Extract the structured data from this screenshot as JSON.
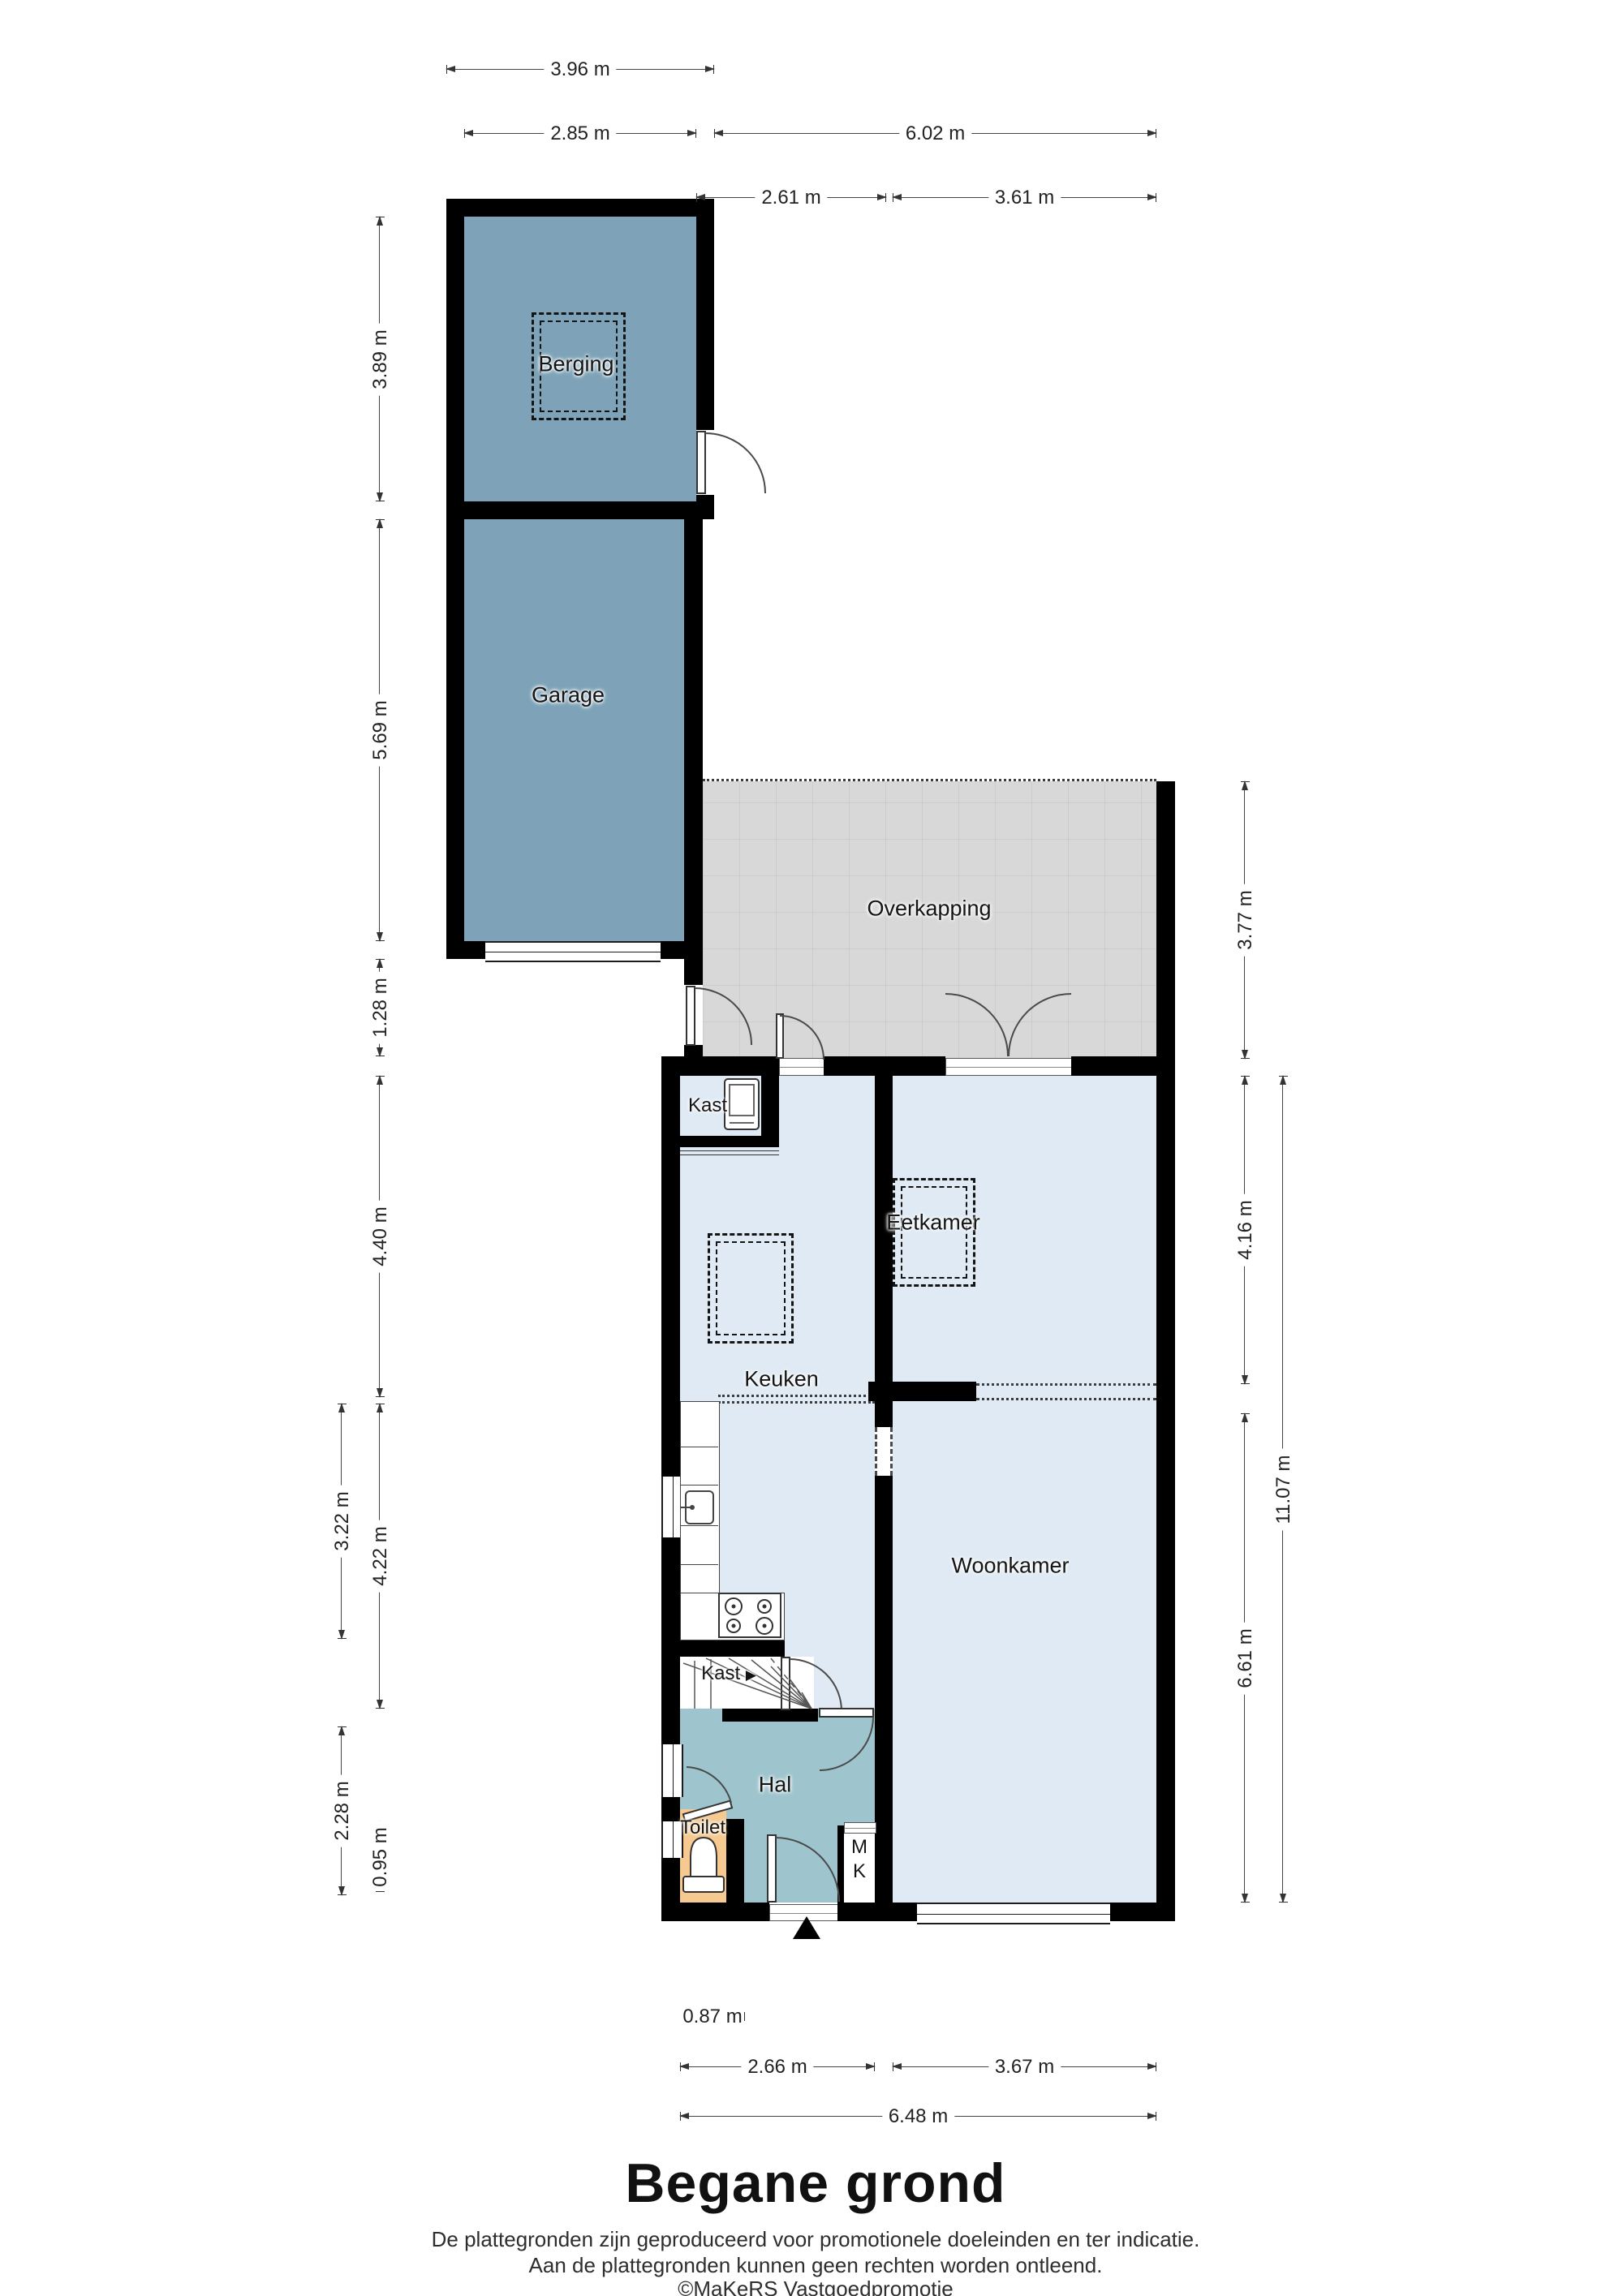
{
  "plan": {
    "title": "Begane grond",
    "footer_line1": "De plattegronden zijn geproduceerd voor promotionele doeleinden en ter indicatie.",
    "footer_line2": "Aan de plattegronden kunnen geen rechten worden ontleend.",
    "footer_line3": "©MaKeRS Vastgoedpromotie"
  },
  "rooms": {
    "berging": "Berging",
    "garage": "Garage",
    "overkapping": "Overkapping",
    "kast_boven": "Kast",
    "keuken": "Keuken",
    "eetkamer": "Eetkamer",
    "woonkamer": "Woonkamer",
    "kast_trap": "Kast",
    "kast_trap_arrow": "▶",
    "hal": "Hal",
    "toilet": "Toilet",
    "meterkast_m": "M",
    "meterkast_k": "K"
  },
  "dimensions": {
    "top": [
      "3.96 m",
      "2.85 m",
      "6.02 m",
      "2.61 m",
      "3.61 m"
    ],
    "left": [
      "3.89 m",
      "5.69 m",
      "1.28 m",
      "4.40 m",
      "4.22 m",
      "0.95 m",
      "3.22 m",
      "2.28 m"
    ],
    "right": [
      "3.77 m",
      "4.16 m",
      "6.61 m",
      "11.07 m"
    ],
    "bottom": [
      "0.87 m",
      "2.66 m",
      "3.67 m",
      "6.48 m"
    ]
  },
  "colors": {
    "wall": "#000000",
    "outbuilding_fill": "#7ea3b8",
    "room_fill": "#dfeaf4",
    "hal_fill": "#9ec5cd",
    "toilet_fill": "#f5c98f",
    "overkapping_fill": "#d8d8d8"
  }
}
